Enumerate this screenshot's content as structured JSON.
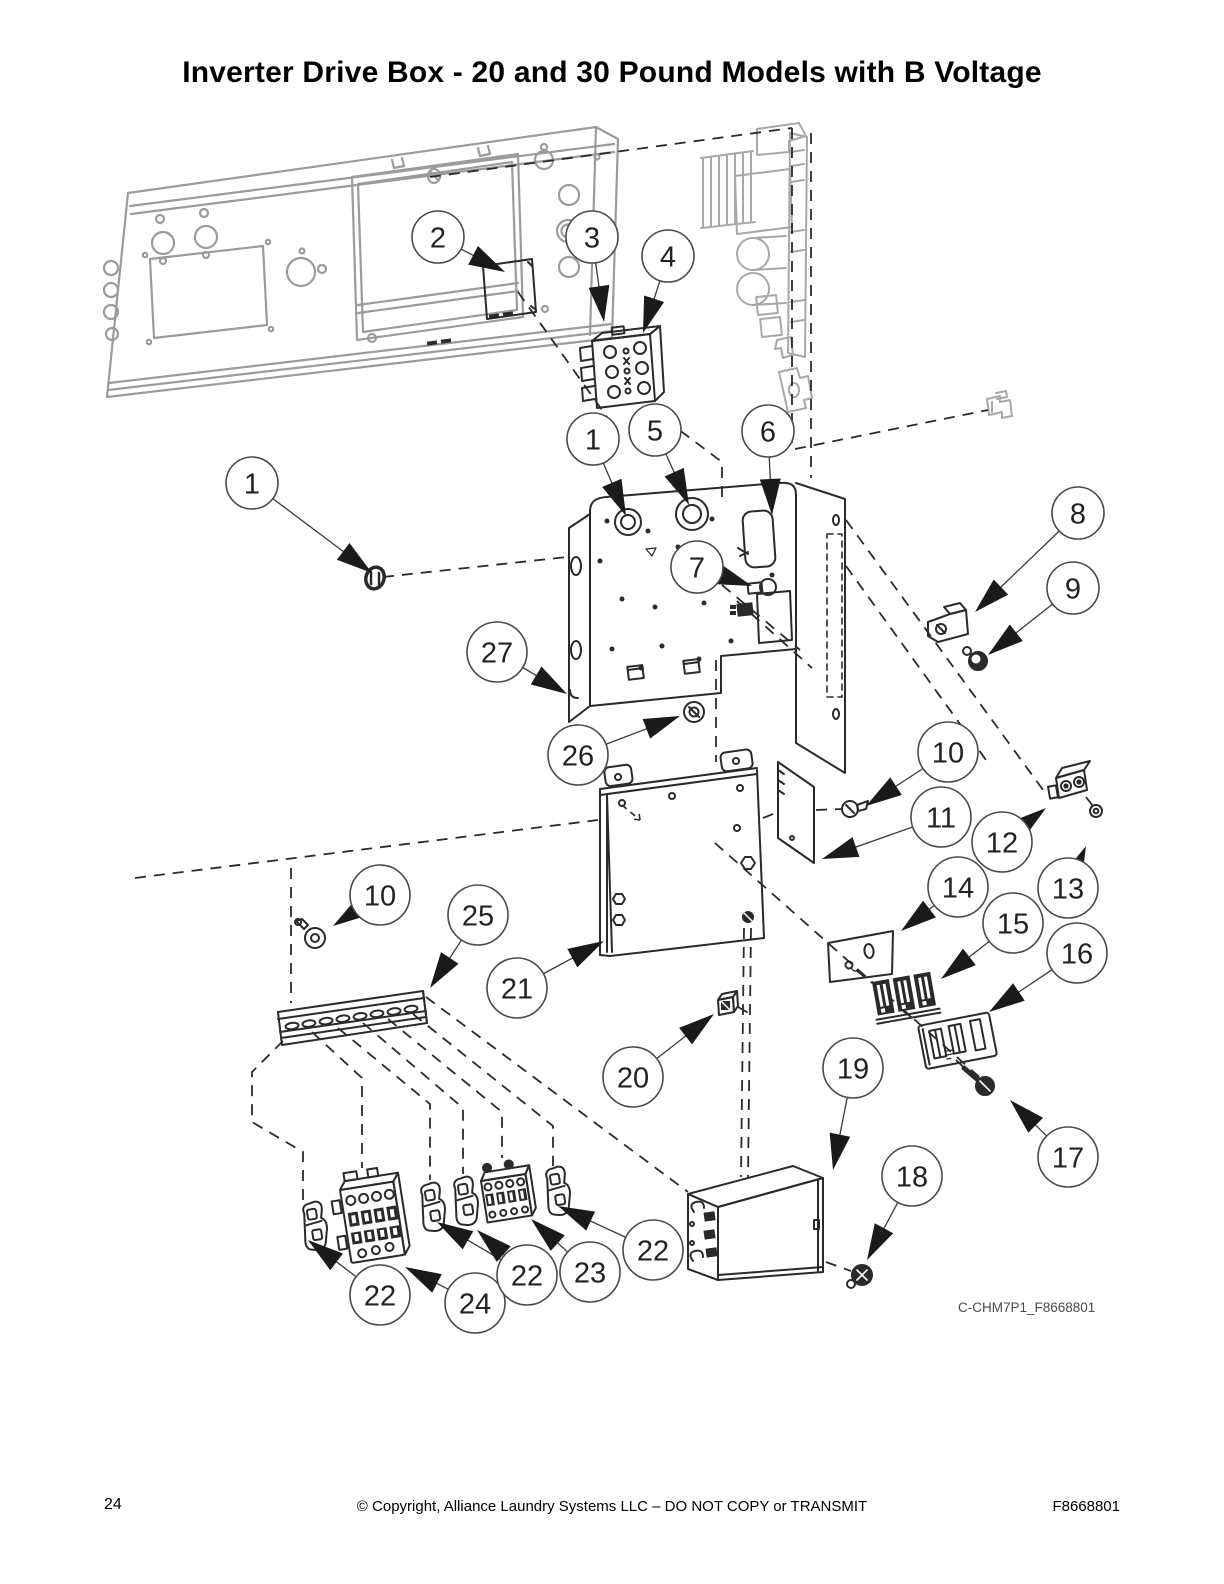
{
  "page": {
    "title": "Inverter Drive Box - 20 and 30 Pound Models with B Voltage",
    "figure_code": "C-CHM7P1_F8668801",
    "footer": {
      "page_number": "24",
      "copyright": "© Copyright, Alliance Laundry Systems LLC – DO NOT COPY or TRANSMIT",
      "document_number": "F8668801"
    }
  },
  "diagram": {
    "description": "Exploded-view parts diagram of the inverter drive box assembly with numbered balloon callouts",
    "colors": {
      "line": "#2a2a2a",
      "gray_part": "#9b9b9b",
      "background": "#ffffff"
    },
    "callouts": [
      {
        "label": "2",
        "cx": 438,
        "cy": 237,
        "targets": [
          [
            505,
            272
          ]
        ]
      },
      {
        "label": "3",
        "cx": 592,
        "cy": 237,
        "targets": [
          [
            604,
            322
          ]
        ]
      },
      {
        "label": "4",
        "cx": 668,
        "cy": 256,
        "targets": [
          [
            643,
            333
          ]
        ]
      },
      {
        "label": "1",
        "cx": 593,
        "cy": 439,
        "targets": [
          [
            626,
            516
          ]
        ]
      },
      {
        "label": "5",
        "cx": 655,
        "cy": 430,
        "targets": [
          [
            689,
            505
          ]
        ]
      },
      {
        "label": "6",
        "cx": 768,
        "cy": 431,
        "targets": [
          [
            772,
            515
          ]
        ]
      },
      {
        "label": "1",
        "cx": 252,
        "cy": 483,
        "targets": [
          [
            372,
            573
          ]
        ]
      },
      {
        "label": "7",
        "cx": 697,
        "cy": 567,
        "targets": [
          [
            752,
            586
          ]
        ]
      },
      {
        "label": "8",
        "cx": 1078,
        "cy": 513,
        "targets": [
          [
            975,
            612
          ]
        ]
      },
      {
        "label": "9",
        "cx": 1073,
        "cy": 588,
        "targets": [
          [
            988,
            655
          ]
        ]
      },
      {
        "label": "27",
        "cx": 497,
        "cy": 652,
        "targets": [
          [
            567,
            694
          ]
        ]
      },
      {
        "label": "26",
        "cx": 578,
        "cy": 755,
        "targets": [
          [
            680,
            716
          ]
        ]
      },
      {
        "label": "10",
        "cx": 948,
        "cy": 752,
        "targets": [
          [
            866,
            806
          ]
        ]
      },
      {
        "label": "11",
        "cx": 941,
        "cy": 817,
        "targets": [
          [
            822,
            859
          ]
        ]
      },
      {
        "label": "12",
        "cx": 1002,
        "cy": 842,
        "targets": [
          [
            1046,
            808
          ]
        ]
      },
      {
        "label": "13",
        "cx": 1068,
        "cy": 888,
        "targets": [
          [
            1086,
            846
          ]
        ]
      },
      {
        "label": "14",
        "cx": 958,
        "cy": 887,
        "targets": [
          [
            901,
            931
          ]
        ]
      },
      {
        "label": "15",
        "cx": 1013,
        "cy": 923,
        "targets": [
          [
            941,
            979
          ]
        ]
      },
      {
        "label": "16",
        "cx": 1077,
        "cy": 953,
        "targets": [
          [
            989,
            1012
          ]
        ]
      },
      {
        "label": "17",
        "cx": 1068,
        "cy": 1157,
        "targets": [
          [
            1010,
            1100
          ]
        ]
      },
      {
        "label": "19",
        "cx": 853,
        "cy": 1068,
        "targets": [
          [
            833,
            1170
          ]
        ]
      },
      {
        "label": "20",
        "cx": 633,
        "cy": 1077,
        "targets": [
          [
            714,
            1014
          ]
        ]
      },
      {
        "label": "18",
        "cx": 912,
        "cy": 1176,
        "targets": [
          [
            867,
            1260
          ]
        ]
      },
      {
        "label": "21",
        "cx": 517,
        "cy": 988,
        "targets": [
          [
            604,
            941
          ]
        ]
      },
      {
        "label": "25",
        "cx": 478,
        "cy": 915,
        "targets": [
          [
            430,
            988
          ]
        ]
      },
      {
        "label": "10",
        "cx": 380,
        "cy": 895,
        "targets": [
          [
            333,
            926
          ]
        ]
      },
      {
        "label": "22",
        "cx": 380,
        "cy": 1295,
        "targets": [
          [
            308,
            1240
          ]
        ]
      },
      {
        "label": "24",
        "cx": 475,
        "cy": 1303,
        "targets": [
          [
            405,
            1267
          ]
        ]
      },
      {
        "label": "22",
        "cx": 527,
        "cy": 1275,
        "targets": [
          [
            437,
            1222
          ],
          [
            477,
            1230
          ]
        ]
      },
      {
        "label": "23",
        "cx": 590,
        "cy": 1272,
        "targets": [
          [
            531,
            1219
          ]
        ]
      },
      {
        "label": "22",
        "cx": 653,
        "cy": 1250,
        "targets": [
          [
            558,
            1206
          ]
        ]
      }
    ]
  }
}
